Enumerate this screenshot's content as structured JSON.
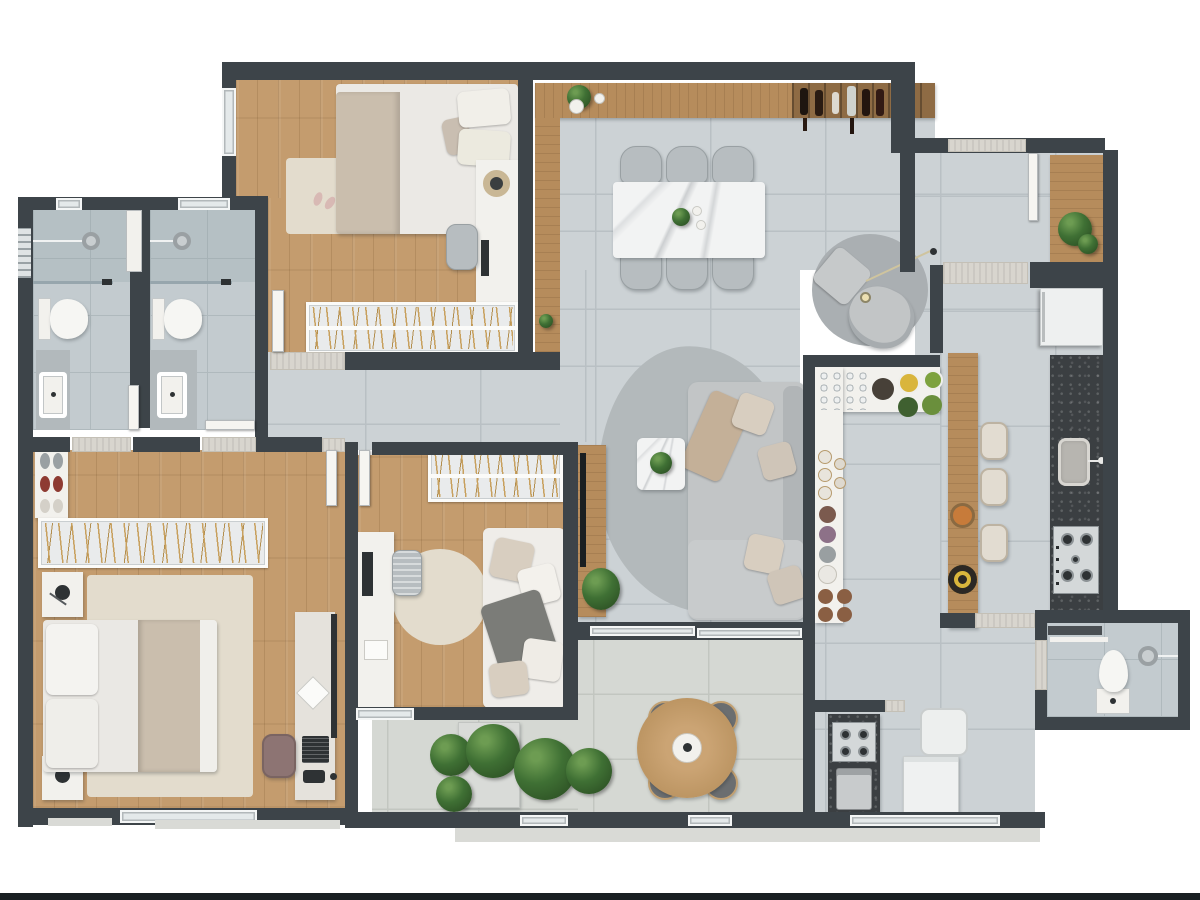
{
  "palette": {
    "wall": "#3d4449",
    "tile": "#ccd2d5",
    "grout": "#b9c0c4",
    "bathtile": "#c3cbcf",
    "bathgrout": "#afb9bd",
    "conc": "#d5d8d3",
    "concline": "#c2c6c0",
    "wood1": "#c49c6e",
    "woodside": "#b68c5c",
    "wooddark": "#8e6b44",
    "gold": "#c8a05e",
    "cream": "#e3dccd",
    "white": "#f2f1ed",
    "doorw": "#f6f5f1",
    "thr": "#d8d5ce",
    "granite": "#3b3f42",
    "dark": "#2e3234",
    "chair": "#b7bdc0",
    "sofa": "#c2c5c6",
    "rug_gray": "#b3b9bb",
    "pillow_beige": "#d8cec0",
    "blanket": "#cabead",
    "marble": "#f2f3f3",
    "accent_green": "#3f7034",
    "accent_orange": "#c77b3a",
    "accent_yellow": "#d9b53c",
    "accent_red": "#8e3a32",
    "bottom_bar": "#1a1f22"
  },
  "plan": {
    "type": "apartment-floor-plan",
    "view": "top-down 3d render",
    "rooms": [
      {
        "name": "bedroom-1",
        "furniture": [
          "double-bed",
          "area-rug",
          "desk-with-lamp",
          "desk-chair",
          "open-wardrobe-hangers",
          "window"
        ]
      },
      {
        "name": "bathroom-1",
        "furniture": [
          "shower-head",
          "glass-partition",
          "toilet",
          "vanity-sink",
          "window"
        ]
      },
      {
        "name": "bathroom-2",
        "furniture": [
          "shower-head",
          "glass-partition",
          "toilet",
          "vanity-sink",
          "duct-shaft",
          "window"
        ]
      },
      {
        "name": "master-bedroom",
        "furniture": [
          "double-bed",
          "nightstand-lamp",
          "nightstand-lamp",
          "area-rug",
          "shoe-shelf",
          "closet-rail-hangers",
          "desk-workstation",
          "laptop",
          "office-chair",
          "window"
        ]
      },
      {
        "name": "bedroom-2",
        "furniture": [
          "daybed-with-pillows",
          "round-rug",
          "desk-with-monitor",
          "office-chair",
          "open-wardrobe-hangers",
          "window"
        ]
      },
      {
        "name": "living-room",
        "furniture": [
          "l-shaped-sofa",
          "organic-rug",
          "coffee-table-with-plant",
          "tv-wood-panel",
          "floor-plant"
        ]
      },
      {
        "name": "reading-nook",
        "furniture": [
          "round-rug",
          "armchair",
          "pouf",
          "arc-floor-lamp"
        ]
      },
      {
        "name": "dining-area",
        "furniture": [
          "marble-dining-table",
          "dining-chair",
          "dining-chair",
          "dining-chair",
          "dining-chair",
          "dining-chair",
          "dining-chair",
          "wood-sideboard",
          "wine-rack-bottles",
          "decor-plant"
        ]
      },
      {
        "name": "kitchen",
        "furniture": [
          "refrigerator",
          "granite-counter",
          "sink",
          "cooktop-4-burners",
          "wood-bar-counter",
          "bar-stool",
          "bar-stool",
          "bar-stool",
          "fruit-bowls"
        ]
      },
      {
        "name": "pantry-counter",
        "furniture": [
          "glass-rack",
          "fruit-bowls",
          "jars",
          "plates",
          "cups"
        ]
      },
      {
        "name": "entry-foyer",
        "furniture": [
          "entrance-door",
          "console-table-with-plant"
        ]
      },
      {
        "name": "balcony",
        "furniture": [
          "round-wood-table",
          "cushion-stool",
          "cushion-stool",
          "cushion-stool",
          "cushion-stool",
          "planter-bench",
          "plants",
          "glass-railing"
        ]
      },
      {
        "name": "service-area",
        "furniture": [
          "bbq-grill-counter",
          "coffee-machine",
          "laundry-sink",
          "washing-machine"
        ]
      },
      {
        "name": "bathroom-3",
        "furniture": [
          "toilet",
          "shower-head",
          "towel-shelf"
        ]
      }
    ]
  }
}
